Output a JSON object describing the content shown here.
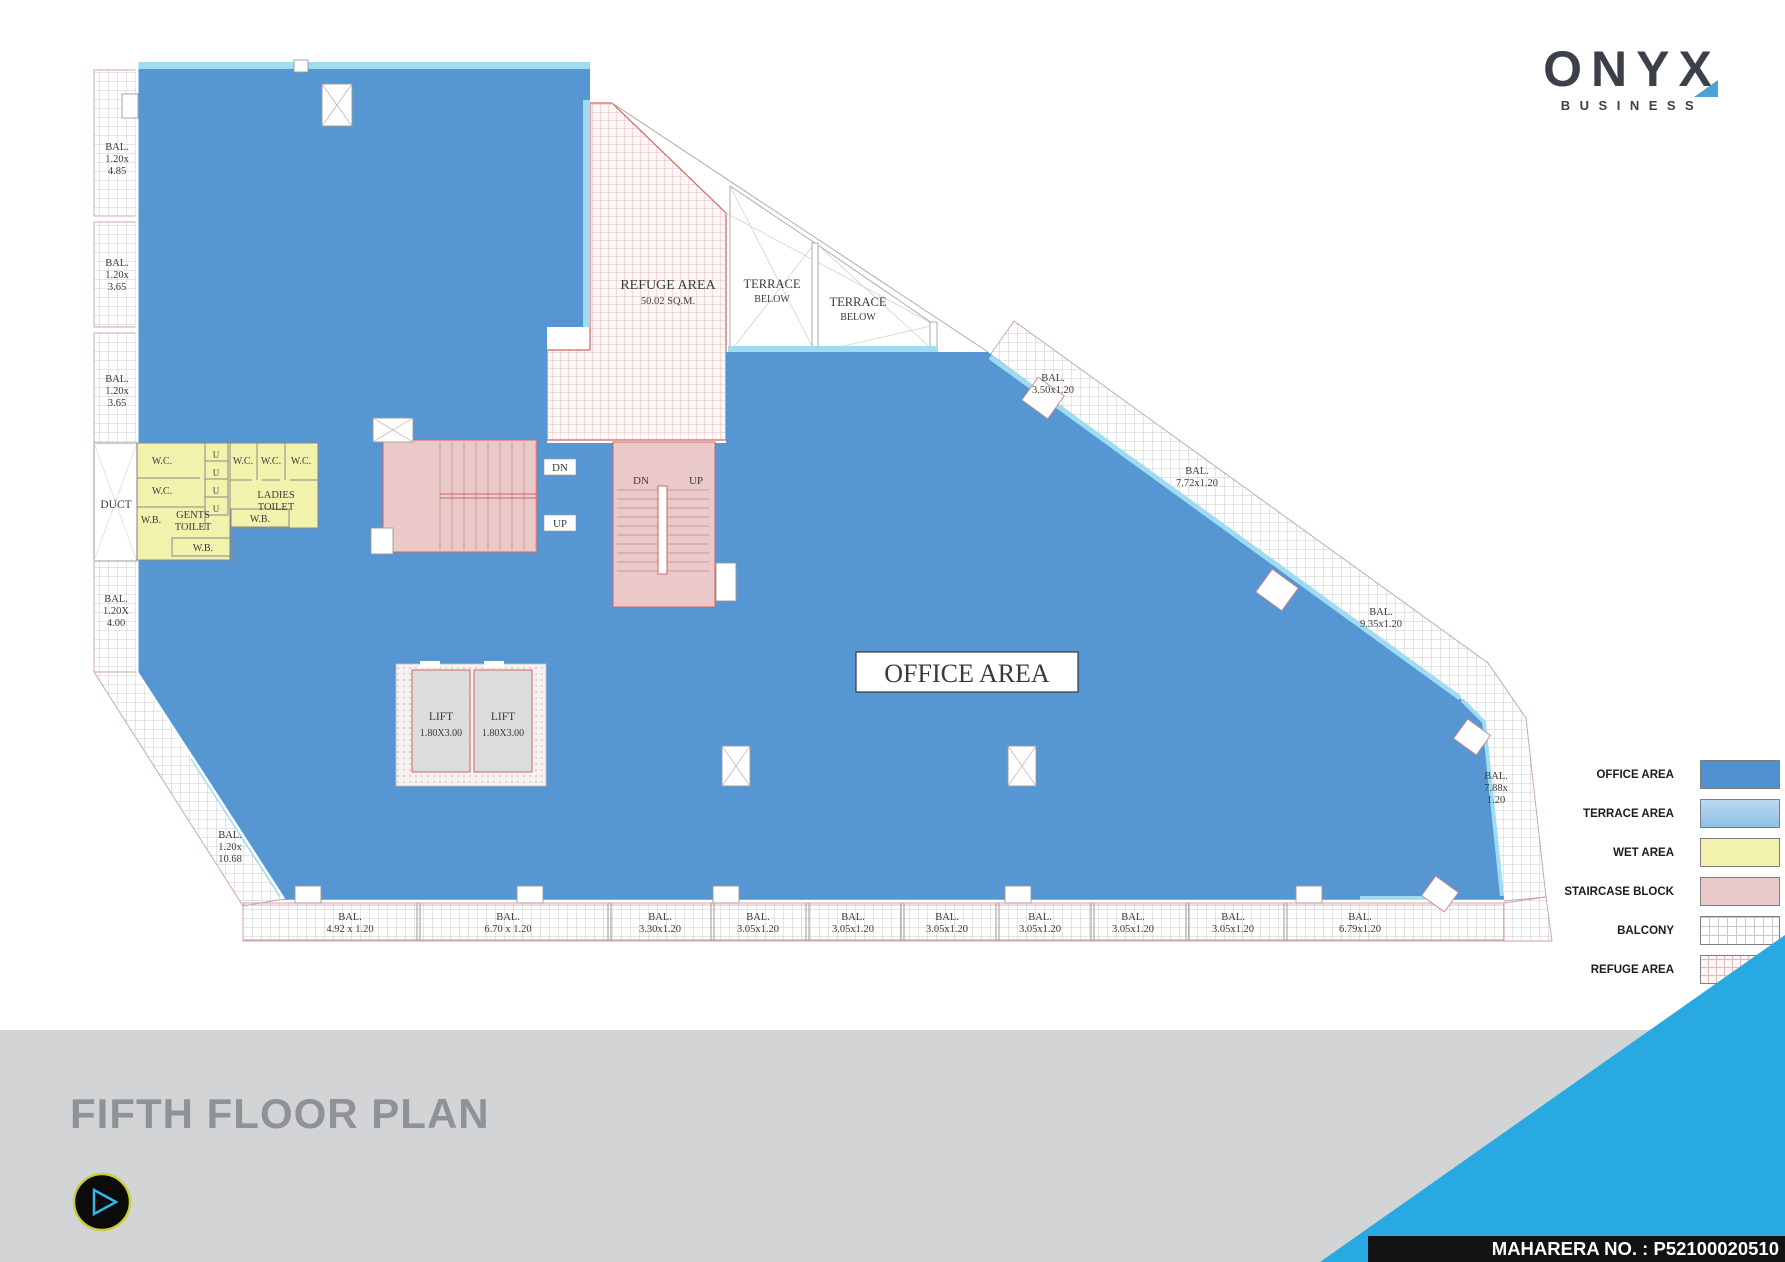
{
  "brand": {
    "name": "ONYX",
    "subtitle": "BUSINESS"
  },
  "footer": {
    "title": "FIFTH FLOOR PLAN",
    "maharera": "MAHARERA NO. : P52100020510"
  },
  "legend": {
    "items": [
      {
        "label": "OFFICE AREA",
        "key": "office"
      },
      {
        "label": "TERRACE AREA",
        "key": "terrace"
      },
      {
        "label": "WET AREA",
        "key": "wet"
      },
      {
        "label": "STAIRCASE BLOCK",
        "key": "staircase"
      },
      {
        "label": "BALCONY",
        "key": "balcony"
      },
      {
        "label": "REFUGE AREA",
        "key": "refuge"
      }
    ]
  },
  "colors": {
    "office_blue": "#5596d3",
    "terrace_blue": "#aacdeb",
    "wet_yellow": "#f2f2ad",
    "staircase_pink": "#ecc9c9",
    "balcony_hatch": "#cbcbcb",
    "refuge_hatch": "#e6bcbc",
    "accent_cyan": "#9fdcf2",
    "brand_blue": "#29a9e1",
    "logo_dark": "#3c4149",
    "title_gray": "#8f9296"
  },
  "plan": {
    "labels": [
      {
        "x": 117,
        "y": 150,
        "s": 10.5,
        "lines": [
          "BAL.",
          "1.20x",
          "4.85"
        ]
      },
      {
        "x": 117,
        "y": 266,
        "s": 10.5,
        "lines": [
          "BAL.",
          "1.20x",
          "3.65"
        ]
      },
      {
        "x": 117,
        "y": 382,
        "s": 10.5,
        "lines": [
          "BAL.",
          "1.20x",
          "3.65"
        ]
      },
      {
        "x": 116,
        "y": 508,
        "s": 11.5,
        "lines": [
          "DUCT"
        ]
      },
      {
        "x": 116,
        "y": 602,
        "s": 10.5,
        "lines": [
          "BAL.",
          "1.20X",
          "4.00"
        ]
      },
      {
        "x": 230,
        "y": 838,
        "s": 10.5,
        "lines": [
          "BAL.",
          "1.20x",
          "10.68"
        ]
      },
      {
        "x": 350,
        "y": 920,
        "s": 10.5,
        "lines": [
          "BAL.",
          "4.92 x 1.20"
        ]
      },
      {
        "x": 508,
        "y": 920,
        "s": 10.5,
        "lines": [
          "BAL.",
          "6.70 x 1.20"
        ]
      },
      {
        "x": 660,
        "y": 920,
        "s": 10.5,
        "lines": [
          "BAL.",
          "3.30x1.20"
        ]
      },
      {
        "x": 758,
        "y": 920,
        "s": 10.5,
        "lines": [
          "BAL.",
          "3.05x1.20"
        ]
      },
      {
        "x": 853,
        "y": 920,
        "s": 10.5,
        "lines": [
          "BAL.",
          "3.05x1.20"
        ]
      },
      {
        "x": 947,
        "y": 920,
        "s": 10.5,
        "lines": [
          "BAL.",
          "3.05x1.20"
        ]
      },
      {
        "x": 1040,
        "y": 920,
        "s": 10.5,
        "lines": [
          "BAL.",
          "3.05x1.20"
        ]
      },
      {
        "x": 1133,
        "y": 920,
        "s": 10.5,
        "lines": [
          "BAL.",
          "3.05x1.20"
        ]
      },
      {
        "x": 1233,
        "y": 920,
        "s": 10.5,
        "lines": [
          "BAL.",
          "3.05x1.20"
        ]
      },
      {
        "x": 1360,
        "y": 920,
        "s": 10.5,
        "lines": [
          "BAL.",
          "6.79x1.20"
        ]
      },
      {
        "x": 1053,
        "y": 381,
        "s": 10.5,
        "lines": [
          "BAL.",
          "3.50x1.20"
        ]
      },
      {
        "x": 1197,
        "y": 474,
        "s": 10.5,
        "lines": [
          "BAL.",
          "7.72x1.20"
        ]
      },
      {
        "x": 1381,
        "y": 615,
        "s": 10.5,
        "lines": [
          "BAL.",
          "9.35x1.20"
        ]
      },
      {
        "x": 1496,
        "y": 779,
        "s": 10.5,
        "lines": [
          "BAL.",
          "7.88x",
          "1.20"
        ]
      },
      {
        "x": 668,
        "y": 289,
        "s": 14,
        "lines": [
          "REFUGE AREA"
        ]
      },
      {
        "x": 668,
        "y": 304,
        "s": 10.5,
        "lines": [
          "50.02 SQ.M."
        ]
      },
      {
        "x": 772,
        "y": 288,
        "s": 12.5,
        "lines": [
          "TERRACE"
        ]
      },
      {
        "x": 772,
        "y": 302,
        "s": 10,
        "lines": [
          "BELOW"
        ]
      },
      {
        "x": 858,
        "y": 306,
        "s": 12.5,
        "lines": [
          "TERRACE"
        ]
      },
      {
        "x": 858,
        "y": 320,
        "s": 10,
        "lines": [
          "BELOW"
        ]
      },
      {
        "x": 560,
        "y": 471,
        "s": 11,
        "lines": [
          "DN"
        ]
      },
      {
        "x": 560,
        "y": 527,
        "s": 11,
        "lines": [
          "UP"
        ]
      },
      {
        "x": 641,
        "y": 484,
        "s": 11,
        "lines": [
          "DN"
        ]
      },
      {
        "x": 696,
        "y": 484,
        "s": 11,
        "lines": [
          "UP"
        ]
      },
      {
        "x": 441,
        "y": 720,
        "s": 11.5,
        "lines": [
          "LIFT"
        ]
      },
      {
        "x": 441,
        "y": 736,
        "s": 10,
        "lines": [
          "1.80X3.00"
        ]
      },
      {
        "x": 503,
        "y": 720,
        "s": 11.5,
        "lines": [
          "LIFT"
        ]
      },
      {
        "x": 503,
        "y": 736,
        "s": 10,
        "lines": [
          "1.80X3.00"
        ]
      },
      {
        "x": 162,
        "y": 464,
        "s": 10,
        "lines": [
          "W.C."
        ]
      },
      {
        "x": 162,
        "y": 494,
        "s": 10,
        "lines": [
          "W.C."
        ]
      },
      {
        "x": 151,
        "y": 523,
        "s": 10,
        "lines": [
          "W.B."
        ]
      },
      {
        "x": 193,
        "y": 518,
        "s": 10.5,
        "lines": [
          "GENTS",
          "TOILET"
        ]
      },
      {
        "x": 203,
        "y": 551,
        "s": 10,
        "lines": [
          "W.B."
        ]
      },
      {
        "x": 216,
        "y": 458,
        "s": 9,
        "lines": [
          "U"
        ]
      },
      {
        "x": 216,
        "y": 476,
        "s": 9,
        "lines": [
          "U"
        ]
      },
      {
        "x": 216,
        "y": 494,
        "s": 9,
        "lines": [
          "U"
        ]
      },
      {
        "x": 216,
        "y": 512,
        "s": 9,
        "lines": [
          "U"
        ]
      },
      {
        "x": 243,
        "y": 464,
        "s": 10,
        "lines": [
          "W.C."
        ]
      },
      {
        "x": 271,
        "y": 464,
        "s": 10,
        "lines": [
          "W.C."
        ]
      },
      {
        "x": 301,
        "y": 464,
        "s": 10,
        "lines": [
          "W.C."
        ]
      },
      {
        "x": 276,
        "y": 498,
        "s": 10.5,
        "lines": [
          "LADIES",
          "TOILET"
        ]
      },
      {
        "x": 260,
        "y": 522,
        "s": 10,
        "lines": [
          "W.B."
        ]
      },
      {
        "x": 967,
        "y": 682,
        "s": 26,
        "lines": [
          "OFFICE AREA"
        ]
      }
    ]
  }
}
